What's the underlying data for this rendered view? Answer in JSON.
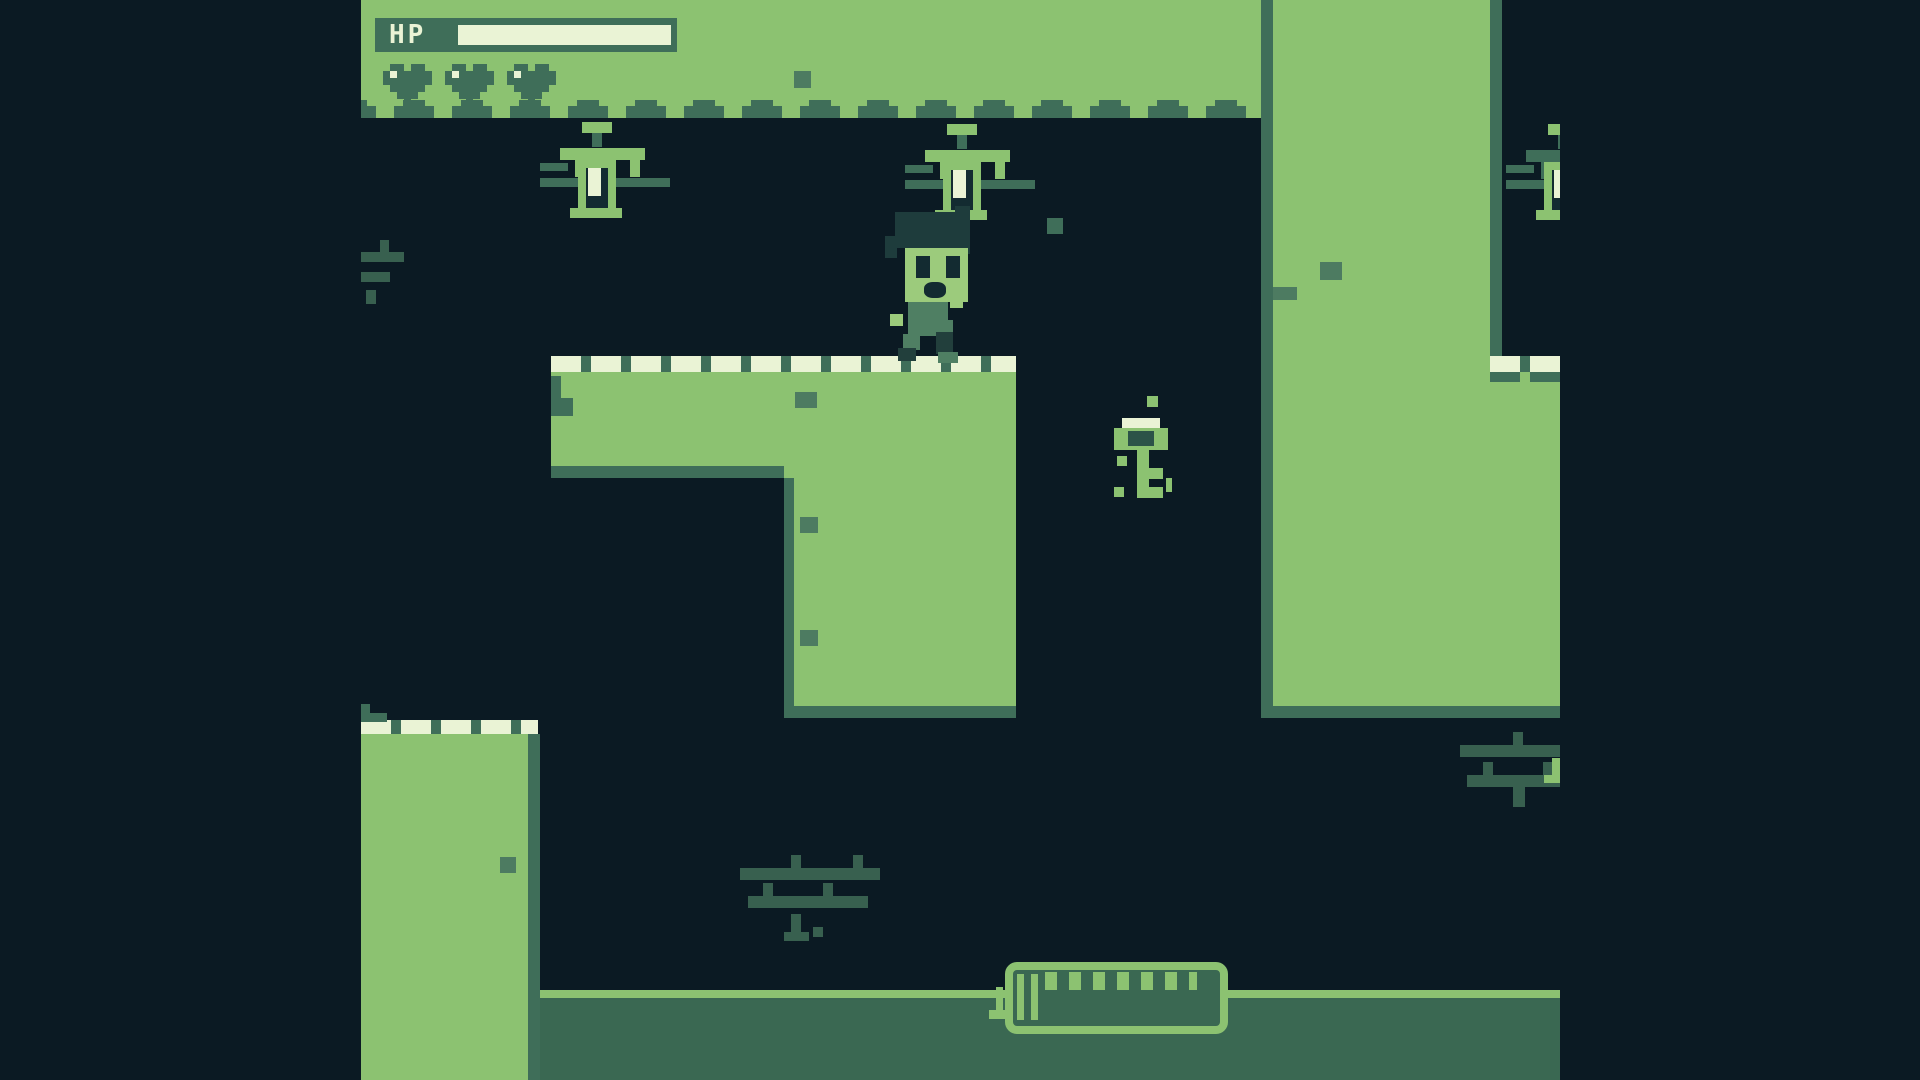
{
  "meta": {
    "title": "Retro pixel platformer game screen",
    "view": "cave room"
  },
  "hud": {
    "hp_label": "HP",
    "hp_value_percent": 100,
    "hearts_count": 3
  },
  "entities": {
    "player": "player character running on dashed platform",
    "key": "floating key collectible with sparkles",
    "lanterns_count": 3,
    "bed": "bed sprite resting on bottom floor",
    "vine_decorations_count": 3
  },
  "palette": {
    "background": "#0b1a23",
    "terrain_green": "#8cc271",
    "shade_teal": "#3f6e59",
    "floor_teal": "#3a6852",
    "vine_teal": "#38604f",
    "cream": "#eaf3d5",
    "sprite_dark": "#132b31",
    "detail_square": "#4d7b61",
    "player_face": "#9ccb7c",
    "player_body": "#4f7f63",
    "player_dark": "#223f3c",
    "key_inner": "#2c5348"
  }
}
